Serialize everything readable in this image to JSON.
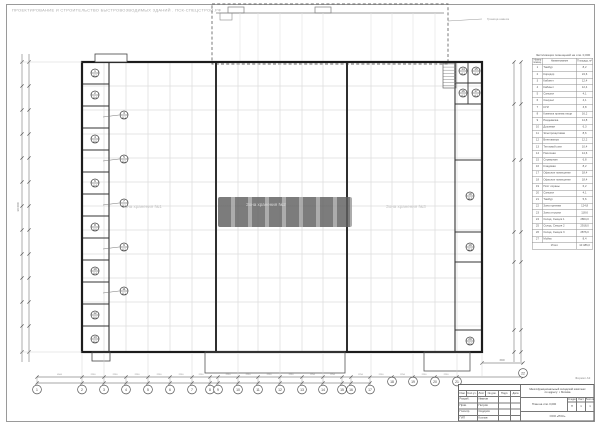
{
  "sheet": {
    "header_line": "ПРОЕКТИРОВАНИЕ И СТРОИТЕЛЬСТВО БЫСТРОВОЗВОДИМЫХ ЗДАНИЙ . ПСК-СПЕЦСТРОЙ.РФ",
    "format_note": "Формат А3"
  },
  "canopy": {
    "note": "Граница навеса"
  },
  "plan": {
    "zones": [
      "Зона хранения №1",
      "Зона хранения №2",
      "Зона хранения №3"
    ],
    "left_rooms": [
      {
        "n": "1",
        "a": "8,2",
        "p": "in"
      },
      {
        "n": "2",
        "a": "8,4",
        "p": "in"
      },
      {
        "n": "3",
        "a": "8,1",
        "p": "out"
      },
      {
        "n": "4",
        "a": "8,6",
        "p": "in"
      },
      {
        "n": "5",
        "a": "8,2",
        "p": "out"
      },
      {
        "n": "6",
        "a": "8,4",
        "p": "in"
      },
      {
        "n": "7",
        "a": "8,1",
        "p": "out"
      },
      {
        "n": "8",
        "a": "8,6",
        "p": "in"
      },
      {
        "n": "9",
        "a": "8,2",
        "p": "out"
      },
      {
        "n": "10",
        "a": "8,4",
        "p": "in"
      },
      {
        "n": "11",
        "a": "8,1",
        "p": "out"
      },
      {
        "n": "12",
        "a": "8,6",
        "p": "in"
      },
      {
        "n": "13",
        "a": "8,2",
        "p": "in"
      }
    ],
    "right_rooms": [
      {
        "n": "14",
        "a": "4,1",
        "cx": 463,
        "cy": 71
      },
      {
        "n": "15",
        "a": "4,1",
        "cx": 476,
        "cy": 71
      },
      {
        "n": "16",
        "a": "4,3",
        "cx": 463,
        "cy": 93
      },
      {
        "n": "17",
        "a": "4,3",
        "cx": 476,
        "cy": 93
      },
      {
        "n": "18",
        "a": "36,5",
        "cx": 470,
        "cy": 196
      },
      {
        "n": "19",
        "a": "12,8",
        "cx": 470,
        "cy": 247
      },
      {
        "n": "20",
        "a": "10,2",
        "cx": 470,
        "cy": 341
      }
    ]
  },
  "axes": {
    "bottom": [
      "1",
      "2",
      "3",
      "4",
      "5",
      "6",
      "7",
      "8",
      "9",
      "10",
      "11",
      "12",
      "13",
      "14",
      "15",
      "16",
      "17",
      "18",
      "19",
      "20",
      "21",
      "22"
    ]
  },
  "dims": {
    "typ": "2250",
    "first": "4500",
    "right": "1500",
    "left_total": "30 000"
  },
  "table": {
    "title": "Экспликация помещений на отм. 0,000",
    "col_num": "Номер помещ.",
    "col_name": "Наименование",
    "col_area": "Площадь, м²",
    "rows": [
      [
        "1",
        "Тамбур",
        "8,2"
      ],
      [
        "2",
        "Коридор",
        "24,6"
      ],
      [
        "3",
        "Кабинет",
        "12,4"
      ],
      [
        "4",
        "Кабинет",
        "12,4"
      ],
      [
        "5",
        "Санузел",
        "4,1"
      ],
      [
        "6",
        "Санузел",
        "4,1"
      ],
      [
        "7",
        "КУИ",
        "3,8"
      ],
      [
        "8",
        "Комната приема пищи",
        "16,2"
      ],
      [
        "9",
        "Раздевалка",
        "14,8"
      ],
      [
        "10",
        "Душевая",
        "6,3"
      ],
      [
        "11",
        "Электрощитовая",
        "8,6"
      ],
      [
        "12",
        "Венткамера",
        "12,2"
      ],
      [
        "13",
        "Тепловой узел",
        "10,4"
      ],
      [
        "14",
        "Насосная",
        "14,6"
      ],
      [
        "15",
        "Серверная",
        "6,8"
      ],
      [
        "16",
        "Кладовая",
        "8,2"
      ],
      [
        "17",
        "Офисное помещение",
        "18,4"
      ],
      [
        "18",
        "Офисное помещение",
        "18,4"
      ],
      [
        "19",
        "Пост охраны",
        "6,2"
      ],
      [
        "20",
        "Санузел",
        "4,1"
      ],
      [
        "21",
        "Тамбур",
        "5,6"
      ],
      [
        "22",
        "Зона приемки",
        "124,8"
      ],
      [
        "23",
        "Зона отгрузки",
        "118,6"
      ],
      [
        "24",
        "Склад. Секция 1",
        "2864,0"
      ],
      [
        "25",
        "Склад. Секция 2",
        "2918,0"
      ],
      [
        "26",
        "Склад. Секция 3",
        "2876,0"
      ],
      [
        "27",
        "Мойка",
        "8,4"
      ]
    ],
    "total_label": "Итого",
    "total_value": "10 486,0"
  },
  "title_block": {
    "cols": [
      "Изм.",
      "Кол.уч.",
      "Лист",
      "№ док.",
      "Подп.",
      "Дата"
    ],
    "roles": [
      [
        "Разраб.",
        "Иванов"
      ],
      [
        "Пров.",
        "Петров"
      ],
      [
        "Н.контр.",
        "Сидоров"
      ],
      [
        "ГИП",
        "Козлов"
      ]
    ],
    "project_line1": "Многофункциональный складской комплекс",
    "project_line2": "по адресу: г. Москва",
    "drawing_title": "План на отм. 0,000",
    "stage_label": "Стадия",
    "sheet_label": "Лист",
    "sheets_label": "Листов",
    "stage": "П",
    "sheet": "1",
    "sheets": "1",
    "org": "ООО «ПСК»"
  },
  "colors": {
    "wall": "#1c1c1c",
    "grid": "#dcdcdc",
    "dim": "#8a8a8a",
    "faint_text": "#c3c3c3",
    "watermark": "#5f5f5f"
  }
}
